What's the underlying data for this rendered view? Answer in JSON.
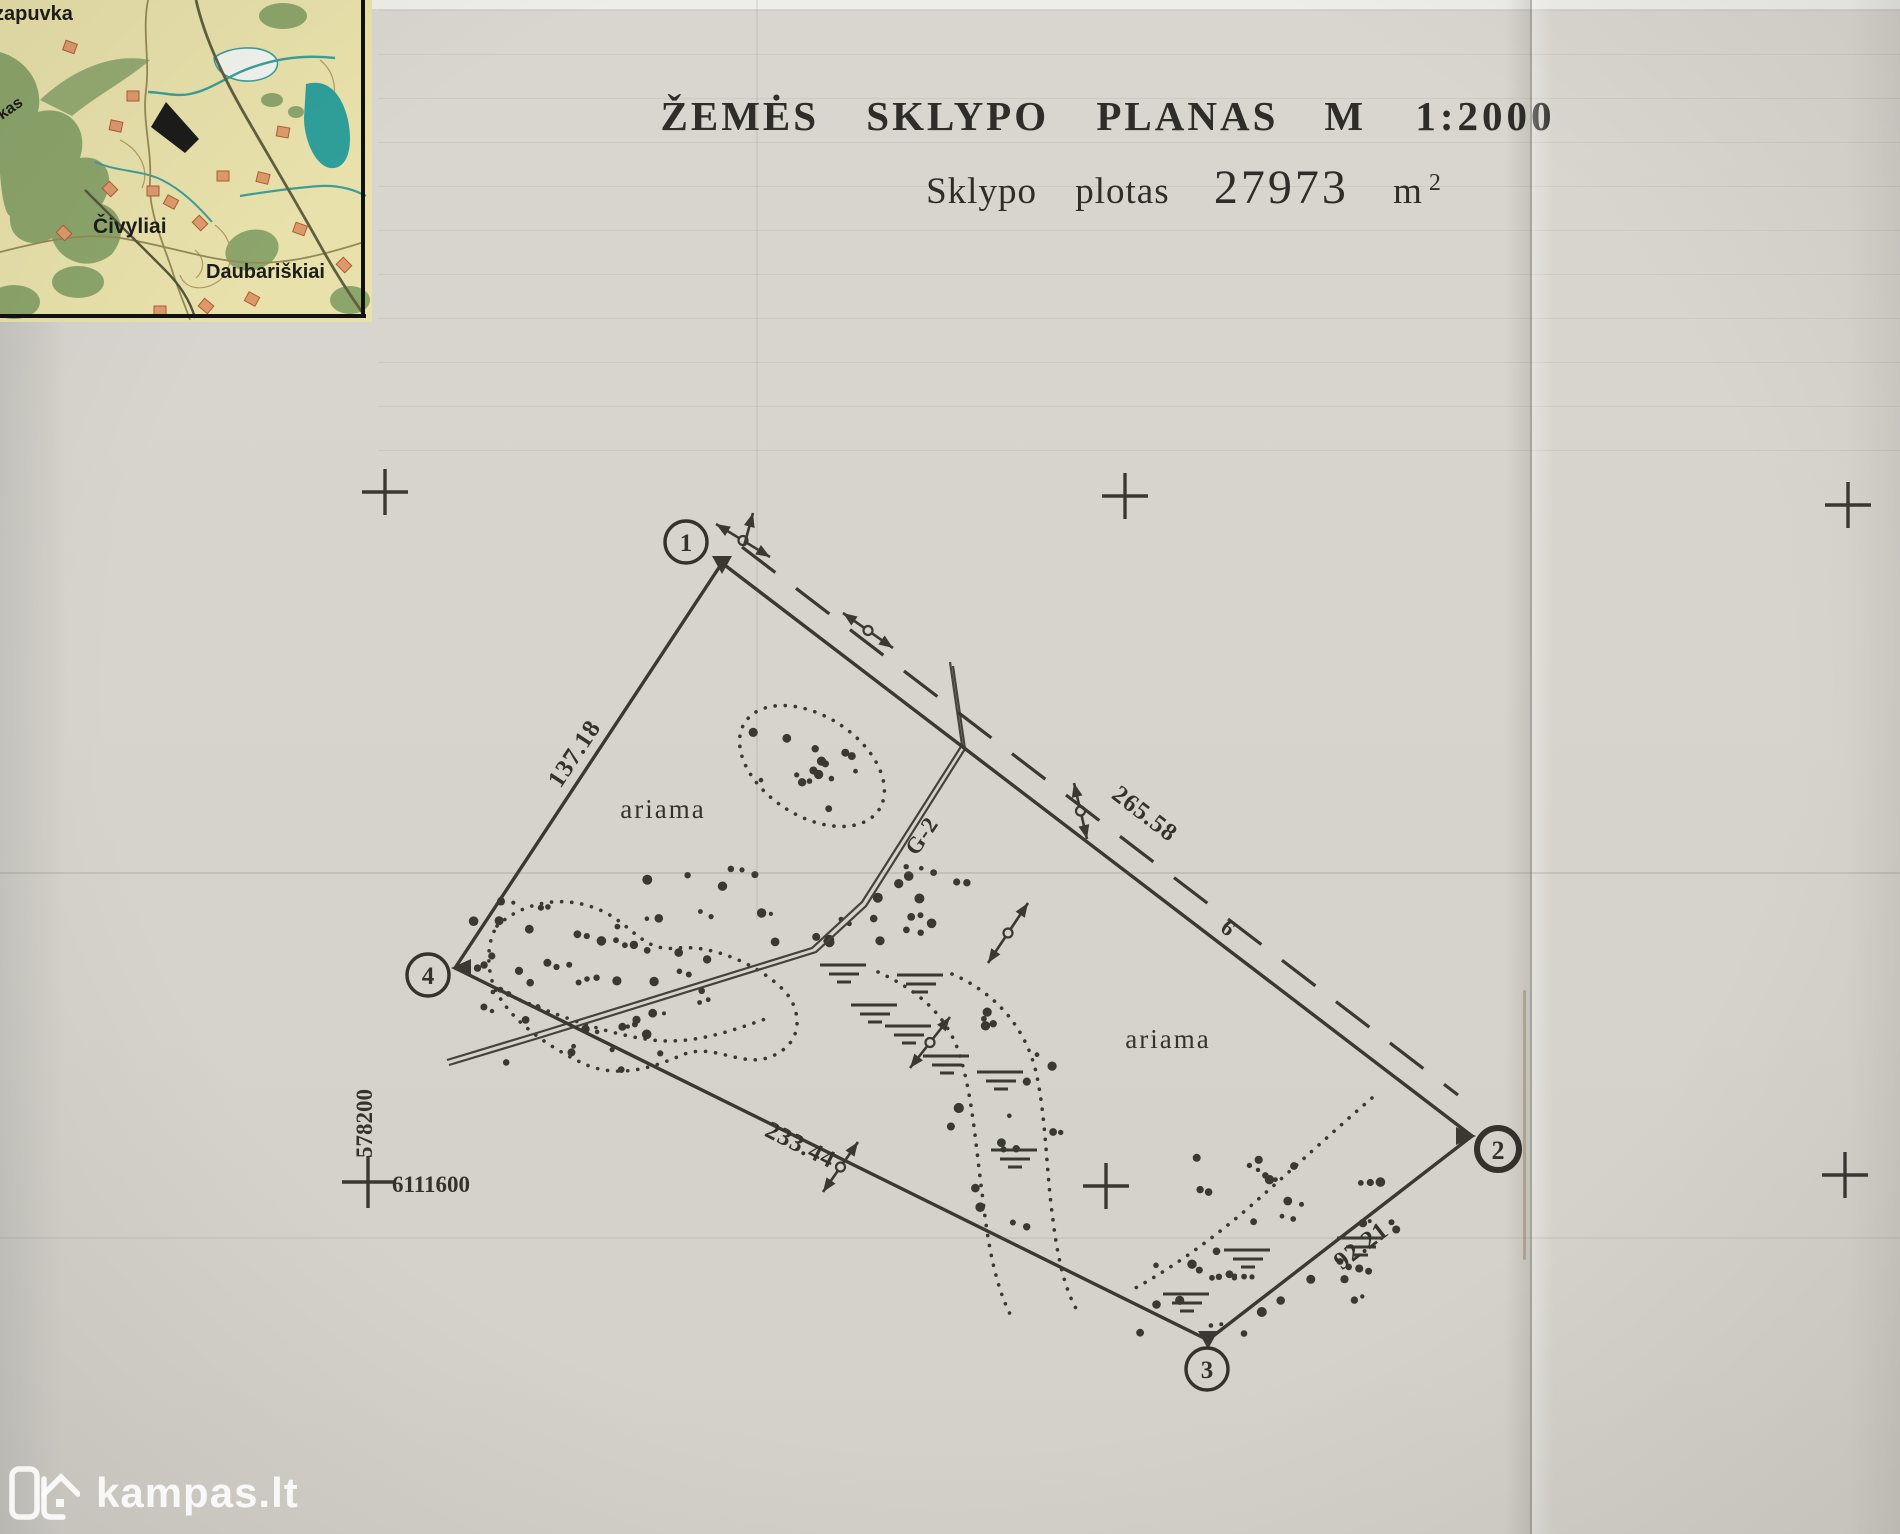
{
  "document": {
    "title": "ŽEMĖS SKLYPO PLANAS",
    "scale": "M 1:2000",
    "area_prefix": "Sklypo plotas",
    "area_value": "27973",
    "area_unit": "m",
    "area_exponent": "2"
  },
  "plot": {
    "corner_points": [
      "1",
      "2",
      "3",
      "4"
    ],
    "side_lengths": {
      "side_1_2": "265.58",
      "side_2_3": "92.21",
      "side_3_4": "233.44",
      "side_4_1": "137.18"
    },
    "land_use_left": "ariama",
    "land_use_right": "ariama",
    "ditch_label": "G-2",
    "road_label": "6",
    "grid_easting": "578200",
    "grid_northing": "6111600"
  },
  "inset_map": {
    "place_top": "zapuvka",
    "place_center": "Čivyliai",
    "place_bottom": "Daubariškiai",
    "place_edge": "kas"
  },
  "watermark": {
    "text": "kampas.lt"
  }
}
